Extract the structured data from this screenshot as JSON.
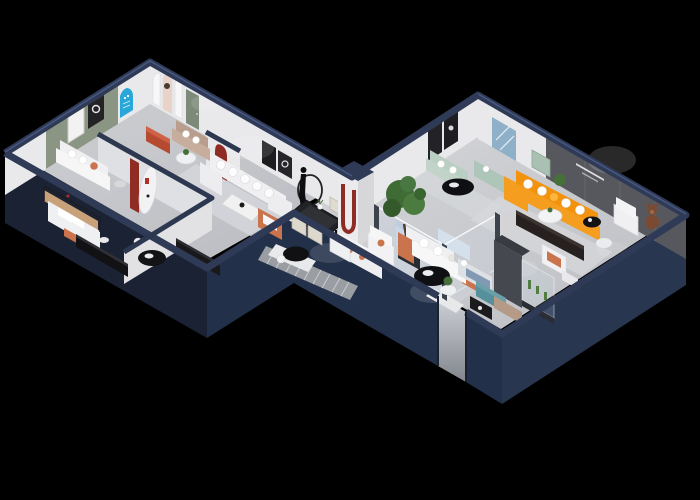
{
  "scene": {
    "type": "3d-isometric-cutaway-floorplan-render",
    "description": "Photorealistic isometric dollhouse render of an L-shaped furniture showroom on a black background with dark navy cut walls",
    "wall_quote_legible": false,
    "rooms": [
      {
        "name": "display-gallery",
        "items": [
          "white arched poster panels",
          "blue arch poster",
          "green door",
          "taupe sofa",
          "rust ottoman",
          "round side table"
        ]
      },
      {
        "name": "sage-lounge",
        "items": [
          "sage accent wall",
          "two framed artworks",
          "white sofa with terracotta pillow"
        ]
      },
      {
        "name": "bedroom-display",
        "items": [
          "canopy bed with terracotta throw",
          "black media console",
          "black oval coffee table",
          "second dark console"
        ]
      },
      {
        "name": "white-sectional-lounge",
        "items": [
          "white U-sectional sofa",
          "white coffee table",
          "terracotta armchair",
          "black framed art",
          "red arch niche"
        ]
      },
      {
        "name": "dining-area",
        "items": [
          "black dining table",
          "cream chairs",
          "mannequin ring floor lamp",
          "white pillar with red U motif"
        ]
      },
      {
        "name": "glass-display-box",
        "items": [
          "pale blue modular sofa",
          "white coffee table",
          "glass partitions"
        ]
      },
      {
        "name": "orange-living-room",
        "items": [
          "orange L-shaped sofa",
          "dark feature wall with small quote",
          "dark media console",
          "white armchair",
          "teddy bear figure",
          "round coffee table"
        ]
      },
      {
        "name": "mint-lounge",
        "items": [
          "mint sofa",
          "mint chaise",
          "black oval table",
          "blue abstract art",
          "teal cabinet"
        ]
      },
      {
        "name": "front-lounge",
        "items": [
          "white sofa with terracotta arms",
          "black oval coffee table",
          "potted tree",
          "white armchair",
          "loveseat"
        ]
      },
      {
        "name": "bedroom-bay",
        "items": [
          "gray wardrobe",
          "pale bed with blue throw",
          "teal bench",
          "tan chaise",
          "glass case with cacti",
          "black shelf"
        ]
      },
      {
        "name": "entrance",
        "items": [
          "striped walkway",
          "lit door opening in outer wall",
          "marble threshold"
        ]
      }
    ]
  },
  "palette": {
    "background": "#000000",
    "wall_outer_dark": "#1a2233",
    "wall_outer": "#223049",
    "wall_outer_light": "#283650",
    "wall_top": "#2e3a56",
    "wall_top_light": "#4e5f8a",
    "floor": "#c6c8cc",
    "floor_light": "#dcdde0",
    "inner_wall": "#e9e9eb",
    "inner_wall_shade": "#dfe0e3",
    "accent_sage": "#8b9583",
    "feature_wall": "#56585e",
    "sofa_orange": "#f59d1e",
    "accent_terracotta": "#c9744c",
    "accent_red": "#8f2d25",
    "poster_blue": "#2aa7d9",
    "art_blue": "#8fb0c9",
    "mint": "#b9cfc3",
    "pale_blue": "#c9d8e8",
    "teal": "#55909b",
    "plant_green": "#466f3a",
    "furniture_white": "#f0f0f2",
    "furniture_black": "#121214",
    "wood_tan": "#b99e8d",
    "bear_brown": "#7a4a33",
    "walkway_gray": "#9a9da2"
  }
}
